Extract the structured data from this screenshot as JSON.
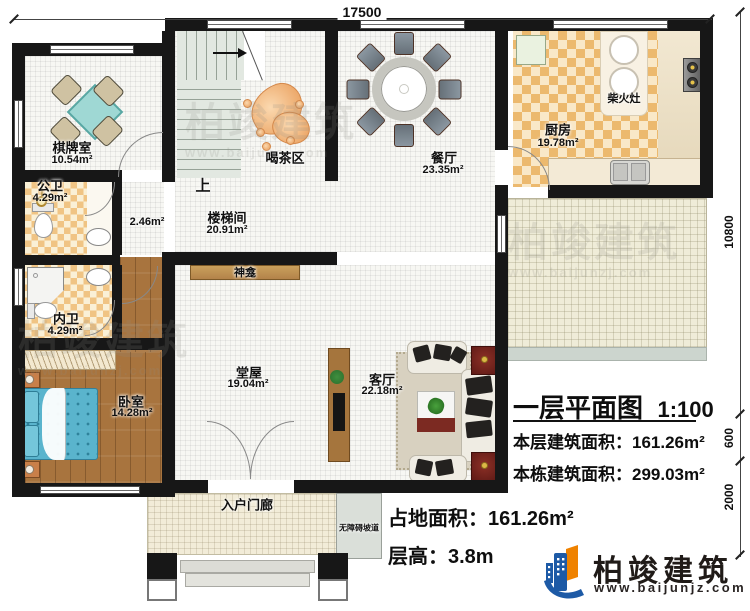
{
  "dims": {
    "top": "17500",
    "right": [
      "10800",
      "600",
      "2000"
    ]
  },
  "rooms": {
    "qipai": {
      "name": "棋牌室",
      "area": "10.54m²"
    },
    "gongwei": {
      "name": "公卫",
      "area": "4.29m²"
    },
    "neiwei": {
      "name": "内卫",
      "area": "4.29m²"
    },
    "corridor": {
      "area": "2.46m²"
    },
    "louti": {
      "name": "楼梯间",
      "area": "20.91m²"
    },
    "hecha": {
      "name": "喝茶区"
    },
    "canting": {
      "name": "餐厅",
      "area": "23.35m²"
    },
    "chufang": {
      "name": "厨房",
      "area": "19.78m²"
    },
    "chaihuozao": {
      "name": "柴火灶"
    },
    "woshi": {
      "name": "卧室",
      "area": "14.28m²"
    },
    "tangwu": {
      "name": "堂屋",
      "area": "19.04m²"
    },
    "keting": {
      "name": "客厅",
      "area": "22.18m²"
    },
    "shenkan": {
      "name": "神龛"
    },
    "porch": {
      "name": "入户门廊"
    },
    "ramp": {
      "name": "无障碍坡道"
    },
    "stair_up": "上"
  },
  "info": {
    "title": "一层平面图",
    "scale": "1:100",
    "floor_area_label": "本层建筑面积：",
    "floor_area": "161.26m²",
    "total_area_label": "本栋建筑面积：",
    "total_area": "299.03m²",
    "land_area_label": "占地面积：",
    "land_area": "161.26m²",
    "height_label": "层高：",
    "height_value": "3.8m"
  },
  "brand": {
    "name": "柏竣建筑",
    "url": "www.baijunjz.com"
  },
  "watermark": {
    "name": "柏竣建筑",
    "url": "www.baijunzj.com"
  },
  "colors": {
    "wall": "#171717",
    "brand_blue": "#1d5aa6",
    "brand_orange": "#ef8200",
    "checker": "#ecb96e",
    "bed": "#5ab4cd",
    "game_table": "#9fd8d4"
  }
}
